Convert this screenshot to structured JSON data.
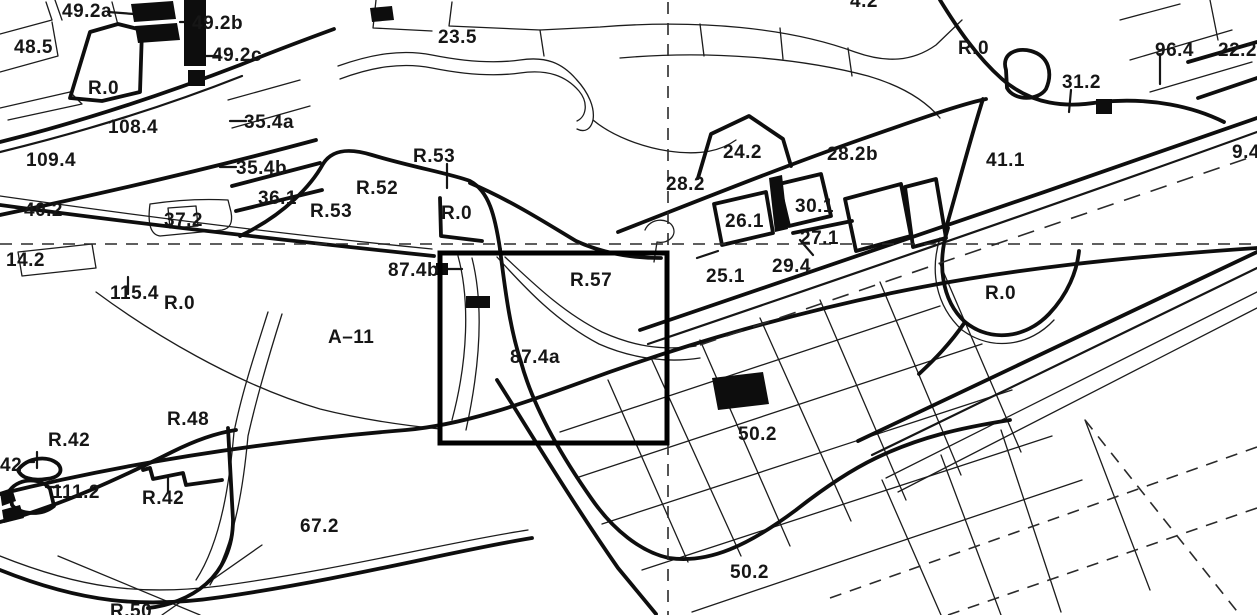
{
  "map": {
    "kind": "cadastral-survey-plan",
    "colors": {
      "ink": "#161616",
      "paper": "#ffffff",
      "highlight": "#000000"
    },
    "highlight_box": {
      "x": 440,
      "y": 253,
      "width": 227,
      "height": 190
    },
    "reference_lines": {
      "horizontal_y": 244,
      "vertical_x": 668
    },
    "labels": [
      {
        "id": "49-2a",
        "text": "49.2a",
        "x": 62,
        "y": 1
      },
      {
        "id": "48-5",
        "text": "48.5",
        "x": 14,
        "y": 37
      },
      {
        "id": "49-2b",
        "text": "49.2b",
        "x": 192,
        "y": 13
      },
      {
        "id": "49-2c",
        "text": "49.2c",
        "x": 212,
        "y": 45
      },
      {
        "id": "r0-topleft",
        "text": "R.0",
        "x": 88,
        "y": 78
      },
      {
        "id": "108-4",
        "text": "108.4",
        "x": 108,
        "y": 117
      },
      {
        "id": "109-4",
        "text": "109.4",
        "x": 26,
        "y": 150
      },
      {
        "id": "35-4a",
        "text": "35.4a",
        "x": 244,
        "y": 112
      },
      {
        "id": "35-4b",
        "text": "35.4b",
        "x": 236,
        "y": 158
      },
      {
        "id": "40-2",
        "text": "40.2",
        "x": 24,
        "y": 200
      },
      {
        "id": "36-1",
        "text": "36.1",
        "x": 258,
        "y": 188
      },
      {
        "id": "37-2",
        "text": "37.2",
        "x": 164,
        "y": 210
      },
      {
        "id": "23-5",
        "text": "23.5",
        "x": 438,
        "y": 27
      },
      {
        "id": "r53-upper",
        "text": "R.53",
        "x": 413,
        "y": 146
      },
      {
        "id": "r52",
        "text": "R.52",
        "x": 356,
        "y": 178
      },
      {
        "id": "r53-lower",
        "text": "R.53",
        "x": 310,
        "y": 201
      },
      {
        "id": "r0-center",
        "text": "R.0",
        "x": 441,
        "y": 203
      },
      {
        "id": "14-2",
        "text": "14.2",
        "x": 6,
        "y": 250
      },
      {
        "id": "115-4",
        "text": "115.4",
        "x": 110,
        "y": 283
      },
      {
        "id": "r0-left",
        "text": "R.0",
        "x": 164,
        "y": 293
      },
      {
        "id": "a-11",
        "text": "A–11",
        "x": 328,
        "y": 327
      },
      {
        "id": "r48",
        "text": "R.48",
        "x": 167,
        "y": 409
      },
      {
        "id": "r42-upper",
        "text": "R.42",
        "x": 48,
        "y": 430
      },
      {
        "id": "42-edge",
        "text": "42",
        "x": 0,
        "y": 455
      },
      {
        "id": "111-2",
        "text": "111.2",
        "x": 52,
        "y": 482
      },
      {
        "id": "r42-lower",
        "text": "R.42",
        "x": 142,
        "y": 488
      },
      {
        "id": "67-2",
        "text": "67.2",
        "x": 300,
        "y": 516
      },
      {
        "id": "87-4b",
        "text": "87.4b",
        "x": 388,
        "y": 260
      },
      {
        "id": "r57",
        "text": "R.57",
        "x": 570,
        "y": 270
      },
      {
        "id": "87-4a",
        "text": "87.4a",
        "x": 510,
        "y": 347
      },
      {
        "id": "50-2-upper",
        "text": "50.2",
        "x": 738,
        "y": 424
      },
      {
        "id": "50-2-lower",
        "text": "50.2",
        "x": 730,
        "y": 562
      },
      {
        "id": "r50",
        "text": "R.50",
        "x": 110,
        "y": 601
      },
      {
        "id": "24-2",
        "text": "24.2",
        "x": 723,
        "y": 142
      },
      {
        "id": "28-2b",
        "text": "28.2b",
        "x": 827,
        "y": 144
      },
      {
        "id": "28-2",
        "text": "28.2",
        "x": 666,
        "y": 174
      },
      {
        "id": "26-1",
        "text": "26.1",
        "x": 725,
        "y": 211
      },
      {
        "id": "30-1",
        "text": "30.1",
        "x": 795,
        "y": 196
      },
      {
        "id": "27-1",
        "text": "27.1",
        "x": 800,
        "y": 228
      },
      {
        "id": "25-1",
        "text": "25.1",
        "x": 706,
        "y": 266
      },
      {
        "id": "29-4",
        "text": "29.4",
        "x": 772,
        "y": 256
      },
      {
        "id": "r0-topright",
        "text": "R.0",
        "x": 958,
        "y": 38
      },
      {
        "id": "31-2",
        "text": "31.2",
        "x": 1062,
        "y": 72
      },
      {
        "id": "41-1",
        "text": "41.1",
        "x": 986,
        "y": 150
      },
      {
        "id": "96-4",
        "text": "96.4",
        "x": 1155,
        "y": 40
      },
      {
        "id": "22-2",
        "text": "22.2",
        "x": 1218,
        "y": 40
      },
      {
        "id": "9-4",
        "text": "9.4",
        "x": 1232,
        "y": 142
      },
      {
        "id": "r0-right",
        "text": "R.0",
        "x": 985,
        "y": 283
      },
      {
        "id": "4-2-top",
        "text": "4.2",
        "x": 850,
        "y": -9
      }
    ]
  }
}
